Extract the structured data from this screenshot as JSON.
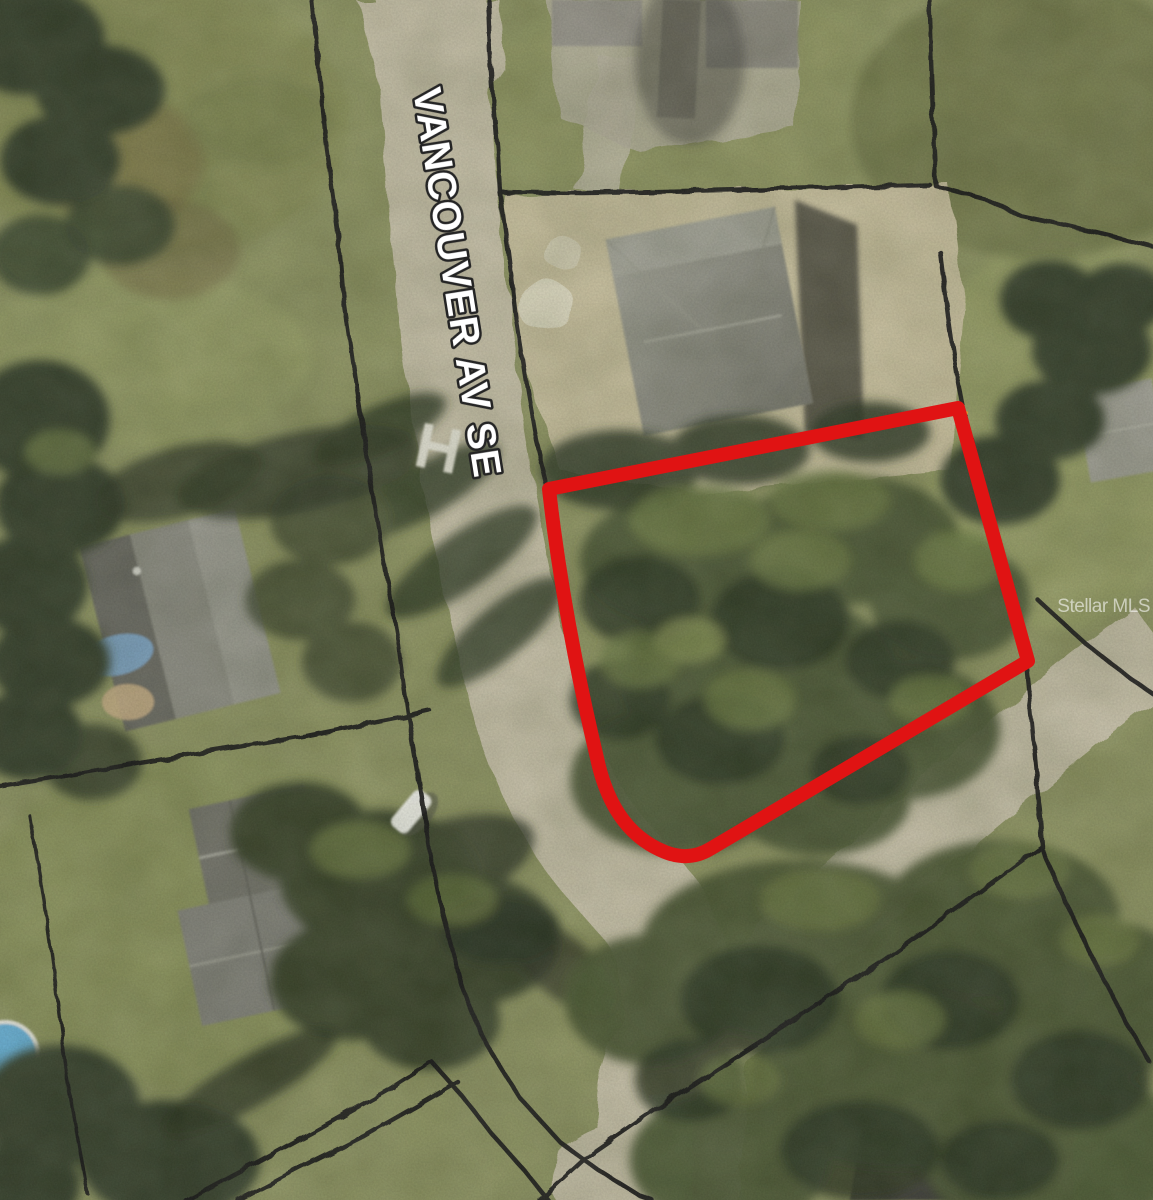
{
  "labels": {
    "street": "VANCOUVER AV SE",
    "watermark": "Stellar MLS"
  },
  "colors": {
    "grass_base": "#8f9562",
    "road": "#c9c2aa",
    "sand": "#cdc3a2",
    "tree_dark": "#36412a",
    "tree_mid": "#4c5833",
    "tree_light": "#6e7d46",
    "roof_gray": "#8d8d83",
    "roof_dark": "#6f6f66",
    "parcel_line": "#191919",
    "lot_outline": "#e01313",
    "street_text": "#ffffff",
    "street_text_outline": "#242424",
    "watermark_color": "#ffffff",
    "tarp_blue": "#7fa8cc",
    "pool_blue": "#66b0d8",
    "car_white": "#f1f1eb",
    "corner_marker": "#e59b2a"
  }
}
